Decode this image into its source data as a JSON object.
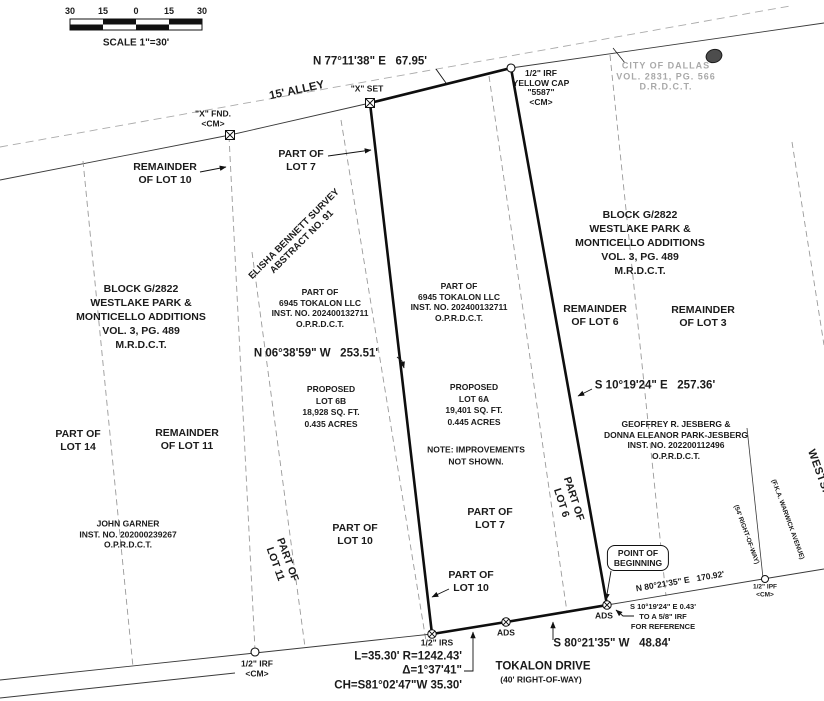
{
  "scale_bar": {
    "ticks": [
      "30",
      "15",
      "0",
      "15",
      "30"
    ],
    "label": "SCALE 1\"=30'"
  },
  "streets": {
    "alley": "15' ALLEY",
    "tokalon": "TOKALON DRIVE",
    "tokalon_row": "(40' RIGHT-OF-WAY)",
    "westshore": "WESTSHORE DRIVE",
    "westshore_fka": "(F.K.A. WARWICK AVENUE)",
    "westshore_row": "(54' RIGHT-OF-WAY)"
  },
  "dimensions": {
    "north": "N 77°11'38\" E   67.95'",
    "west": "N 06°38'59\" W   253.51'",
    "east": "S 10°19'24\" E   257.36'",
    "south": "S 80°21'35\" W   48.84'",
    "tie": "N 80°21'35\" E   170.92'",
    "curve_l_r": "L=35.30' R=1242.43'",
    "curve_delta": "Δ=1°37'41\"",
    "curve_ch": "CH=S81°02'47\"W 35.30'",
    "reference": "S 10°19'24\" E 0.43'\nTO A 5/8\" IRF\nFOR REFERENCE"
  },
  "monuments": {
    "x_fnd": "\"X\" FND.\n<CM>",
    "x_set": "\"X\" SET",
    "irf_cap": "1/2\" IRF\nYELLOW CAP\n\"5587\"\n<CM>",
    "irs": "1/2\" IRS",
    "irf_sw": "1/2\" IRF\n<CM>",
    "ipf": "1/2\" IPF\n<CM>",
    "ads": "ADS",
    "pob": "POINT OF\nBEGINNING"
  },
  "survey": {
    "abstract": "ELISHA BENNETT SURVEY\nABSTRACT NO. 91",
    "block_left": "BLOCK G/2822\nWESTLAKE PARK &\nMONTICELLO ADDITIONS\nVOL. 3, PG. 489\nM.R.D.C.T.",
    "block_right": "BLOCK G/2822\nWESTLAKE PARK &\nMONTICELLO ADDITIONS\nVOL. 3, PG. 489\nM.R.D.C.T.",
    "city": "CITY OF DALLAS\nVOL. 2831, PG. 566\nD.R.D.C.T."
  },
  "lots": {
    "rem10": "REMAINDER\nOF LOT 10",
    "part7_top": "PART OF\nLOT 7",
    "part14": "PART OF\nLOT 14",
    "rem11": "REMAINDER\nOF LOT 11",
    "part11": "PART OF\nLOT 11",
    "part10_mid": "PART OF\nLOT 10",
    "part10_low": "PART OF\nLOT 10",
    "part7_low": "PART OF\nLOT 7",
    "part6": "PART OF\nLOT 6",
    "rem6": "REMAINDER\nOF LOT 6",
    "rem3": "REMAINDER\nOF LOT 3",
    "proposed_6b": "PROPOSED\nLOT 6B\n18,928 SQ. FT.\n0.435 ACRES",
    "proposed_6a": "PROPOSED\nLOT 6A\n19,401 SQ. FT.\n0.445 ACRES",
    "note": "NOTE: IMPROVEMENTS\nNOT SHOWN."
  },
  "owners": {
    "tokalon_w": "PART OF\n6945 TOKALON LLC\nINST. NO. 202400132711\nO.P.R.D.C.T.",
    "tokalon_e": "PART OF\n6945 TOKALON LLC\nINST. NO. 202400132711\nO.P.R.D.C.T.",
    "jesberg": "GEOFFREY R. JESBERG &\nDONNA ELEANOR PARK-JESBERG\nINST. NO. 202200112496\nO.P.R.D.C.T.",
    "garner": "JOHN GARNER\nINST. NO. 202000239267\nO.P.R.D.C.T."
  }
}
